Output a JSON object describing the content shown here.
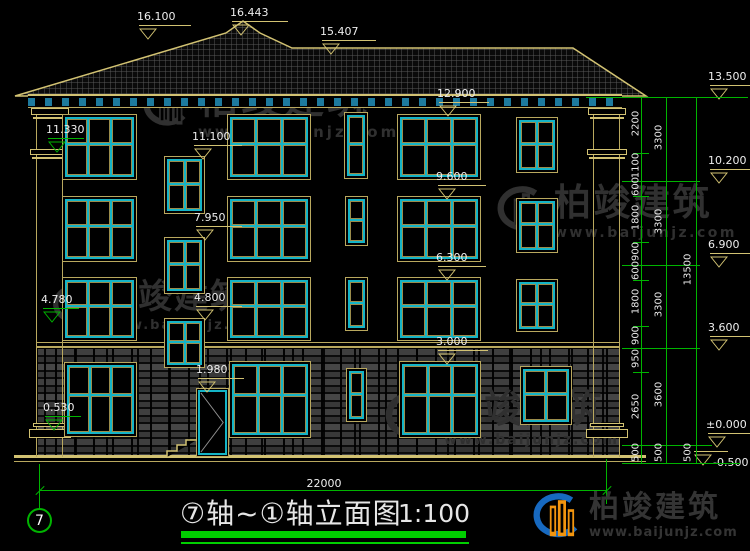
{
  "titlebar": {
    "title": "⑦轴~①轴立面图",
    "scale": "1:100",
    "axis_label": "7",
    "span_dim": "22000"
  },
  "watermark": {
    "brand": "柏竣建筑",
    "url": "www.baijunjz.com"
  },
  "logo": {
    "brand": "柏竣建筑",
    "url": "www.baijunjz.com"
  },
  "colors": {
    "tan": "#b9a85e",
    "bright_tan": "#d2c272",
    "cyan": "#14b4c6",
    "pane": "#9b8c4b",
    "green": "#00b400",
    "bright_green": "#00cf00",
    "white": "#ededed",
    "watermark": "#303030",
    "logo_text": "#343434",
    "logo_blue": "#1769c0",
    "logo_orange": "#f2950f",
    "bracket_blue": "#1d7a9e",
    "door_swing": "#909090"
  },
  "roof": {
    "outline": "15,96 226,33 243,21 260,33 292,48 573,48 646,96",
    "tile_line": "#575757",
    "tile_bg": "#0a0a0a"
  },
  "levels": {
    "markers": [
      {
        "label": "16.100",
        "x": 148,
        "y": 37,
        "lw": 52
      },
      {
        "label": "16.443",
        "x": 241,
        "y": 33,
        "lw": 56
      },
      {
        "label": "15.407",
        "x": 331,
        "y": 52,
        "lw": 54
      },
      {
        "label": "12.900",
        "x": 448,
        "y": 114,
        "lw": 50
      },
      {
        "label": "9.600",
        "x": 447,
        "y": 197,
        "lw": 48
      },
      {
        "label": "6.300",
        "x": 447,
        "y": 278,
        "lw": 48
      },
      {
        "label": "3.000",
        "x": 447,
        "y": 362,
        "lw": 50
      },
      {
        "label": "11.100",
        "x": 203,
        "y": 157,
        "lw": 48
      },
      {
        "label": "7.950",
        "x": 205,
        "y": 238,
        "lw": 46
      },
      {
        "label": "4.800",
        "x": 205,
        "y": 318,
        "lw": 46
      },
      {
        "label": "1.980",
        "x": 207,
        "y": 390,
        "lw": 46
      },
      {
        "label": "11.330",
        "x": 57,
        "y": 150,
        "lw": 36,
        "green": true
      },
      {
        "label": "4.780",
        "x": 52,
        "y": 320,
        "lw": 36,
        "green": true
      },
      {
        "label": "0.530",
        "x": 54,
        "y": 428,
        "lw": 36,
        "green": true
      },
      {
        "label": "13.500",
        "x": 719,
        "y": 97,
        "lw": 42
      },
      {
        "label": "10.200",
        "x": 719,
        "y": 181,
        "lw": 42
      },
      {
        "label": "6.900",
        "x": 719,
        "y": 265,
        "lw": 40
      },
      {
        "label": "3.600",
        "x": 719,
        "y": 348,
        "lw": 40
      },
      {
        "label": "±0.000",
        "x": 717,
        "y": 445,
        "lw": 44
      },
      {
        "label": "-0.500",
        "x": 703,
        "y": 463,
        "lw": 34,
        "textRight": true
      }
    ]
  },
  "chains": {
    "verticals": [
      {
        "x": 641,
        "y1": 97,
        "y2": 463
      },
      {
        "x": 666,
        "y1": 97,
        "y2": 463
      },
      {
        "x": 696,
        "y1": 97,
        "y2": 463
      }
    ],
    "level_lines": [
      {
        "y": 97,
        "x1": 586,
        "x2": 748
      },
      {
        "y": 181,
        "x1": 622,
        "x2": 700
      },
      {
        "y": 265,
        "x1": 622,
        "x2": 700
      },
      {
        "y": 348,
        "x1": 622,
        "x2": 700
      },
      {
        "y": 445,
        "x1": 622,
        "x2": 712
      },
      {
        "y": 463,
        "x1": 622,
        "x2": 740
      }
    ],
    "ticks": {
      "x1": 633,
      "x2": 649,
      "ys": [
        153,
        196,
        242,
        280,
        326,
        372
      ]
    },
    "labels": [
      {
        "x": 636,
        "items": [
          [
            "2200",
            125
          ],
          [
            "1100",
            167
          ],
          [
            "600",
            188
          ],
          [
            "1800",
            219
          ],
          [
            "900",
            253
          ],
          [
            "600",
            272
          ],
          [
            "1800",
            303
          ],
          [
            "900",
            337
          ],
          [
            "950",
            360
          ],
          [
            "2650",
            408
          ],
          [
            "500",
            454
          ]
        ]
      },
      {
        "x": 659,
        "items": [
          [
            "3300",
            139
          ],
          [
            "3300",
            223
          ],
          [
            "3300",
            306
          ],
          [
            "3600",
            396
          ],
          [
            "500",
            454
          ]
        ]
      },
      {
        "x": 688,
        "items": [
          [
            "13500",
            271
          ],
          [
            "500",
            454
          ]
        ]
      }
    ]
  },
  "span": {
    "line": {
      "x1": 40,
      "x2": 607,
      "y": 490
    },
    "left_v": {
      "x": 39,
      "y1": 464,
      "y2": 509
    },
    "right_v": {
      "x": 606,
      "y1": 459,
      "y2": 504
    },
    "text_x": 297,
    "text_y": 477
  },
  "structure": {
    "eave": {
      "x": 28,
      "y": 94,
      "w": 594,
      "h": 14
    },
    "stone": {
      "x": 36,
      "y": 349,
      "w": 584,
      "h": 108
    },
    "stone_lines": [
      {
        "x": 36,
        "y": 342,
        "w": 584,
        "h": 1
      },
      {
        "x": 36,
        "y": 346,
        "w": 584,
        "h": 2
      }
    ],
    "ground": [
      {
        "x": 14,
        "y": 455,
        "w": 632,
        "h": 3
      },
      {
        "x": 14,
        "y": 461,
        "w": 632,
        "h": 1
      }
    ],
    "pilasters": [
      {
        "x": 36,
        "y": 108,
        "w": 27,
        "h": 349
      },
      {
        "x": 593,
        "y": 108,
        "w": 27,
        "h": 349
      }
    ],
    "caps": [
      {
        "x": 31,
        "y": 108,
        "w": 38,
        "h": 7
      },
      {
        "x": 33,
        "y": 117,
        "w": 34,
        "h": 2
      },
      {
        "x": 30,
        "y": 149,
        "w": 40,
        "h": 6
      },
      {
        "x": 32,
        "y": 157,
        "w": 36,
        "h": 2
      },
      {
        "x": 33,
        "y": 423,
        "w": 34,
        "h": 4
      },
      {
        "x": 29,
        "y": 429,
        "w": 42,
        "h": 9
      },
      {
        "x": 588,
        "y": 108,
        "w": 38,
        "h": 7
      },
      {
        "x": 590,
        "y": 117,
        "w": 34,
        "h": 2
      },
      {
        "x": 587,
        "y": 149,
        "w": 40,
        "h": 6
      },
      {
        "x": 589,
        "y": 157,
        "w": 36,
        "h": 2
      },
      {
        "x": 590,
        "y": 423,
        "w": 34,
        "h": 4
      },
      {
        "x": 586,
        "y": 429,
        "w": 42,
        "h": 9
      }
    ]
  },
  "windows": [
    {
      "x": 62,
      "y": 114,
      "w": 75,
      "h": 66,
      "t": "l"
    },
    {
      "x": 227,
      "y": 114,
      "w": 84,
      "h": 66,
      "t": "l"
    },
    {
      "x": 397,
      "y": 114,
      "w": 84,
      "h": 66,
      "t": "l"
    },
    {
      "x": 516,
      "y": 117,
      "w": 42,
      "h": 56,
      "t": "s"
    },
    {
      "x": 344,
      "y": 112,
      "w": 24,
      "h": 67,
      "t": "n"
    },
    {
      "x": 164,
      "y": 156,
      "w": 41,
      "h": 58,
      "t": "s"
    },
    {
      "x": 62,
      "y": 196,
      "w": 75,
      "h": 66,
      "t": "l"
    },
    {
      "x": 227,
      "y": 196,
      "w": 84,
      "h": 66,
      "t": "l"
    },
    {
      "x": 397,
      "y": 196,
      "w": 84,
      "h": 66,
      "t": "l"
    },
    {
      "x": 516,
      "y": 198,
      "w": 42,
      "h": 55,
      "t": "s"
    },
    {
      "x": 345,
      "y": 196,
      "w": 23,
      "h": 50,
      "t": "n"
    },
    {
      "x": 164,
      "y": 237,
      "w": 41,
      "h": 57,
      "t": "s"
    },
    {
      "x": 62,
      "y": 277,
      "w": 75,
      "h": 64,
      "t": "l"
    },
    {
      "x": 227,
      "y": 277,
      "w": 84,
      "h": 64,
      "t": "l"
    },
    {
      "x": 397,
      "y": 277,
      "w": 84,
      "h": 64,
      "t": "l"
    },
    {
      "x": 516,
      "y": 279,
      "w": 42,
      "h": 53,
      "t": "s"
    },
    {
      "x": 345,
      "y": 277,
      "w": 23,
      "h": 54,
      "t": "n"
    },
    {
      "x": 164,
      "y": 318,
      "w": 41,
      "h": 50,
      "t": "s"
    },
    {
      "x": 64,
      "y": 362,
      "w": 73,
      "h": 75,
      "t": "l"
    },
    {
      "x": 229,
      "y": 361,
      "w": 82,
      "h": 77,
      "t": "l"
    },
    {
      "x": 399,
      "y": 361,
      "w": 82,
      "h": 77,
      "t": "l"
    },
    {
      "x": 520,
      "y": 366,
      "w": 52,
      "h": 59,
      "t": "s"
    },
    {
      "x": 346,
      "y": 368,
      "w": 21,
      "h": 54,
      "t": "n"
    }
  ],
  "door": {
    "x": 196,
    "y": 388,
    "w": 33,
    "h": 69
  },
  "steps": {
    "x": 166,
    "y": 437,
    "w": 32,
    "h": 21
  },
  "watermarks_pos": [
    {
      "x": 140,
      "y": 80,
      "iw": 52,
      "ih": 58,
      "ts": 40,
      "ws": 15,
      "ls": 3
    },
    {
      "x": 50,
      "y": 280,
      "iw": 46,
      "ih": 56,
      "ts": 34,
      "ws": 13,
      "ls": 2
    },
    {
      "x": 494,
      "y": 184,
      "iw": 54,
      "ih": 58,
      "ts": 37,
      "ws": 14,
      "ls": 2.5
    },
    {
      "x": 382,
      "y": 390,
      "iw": 56,
      "ih": 60,
      "ts": 38,
      "ws": 14,
      "ls": 2
    }
  ]
}
